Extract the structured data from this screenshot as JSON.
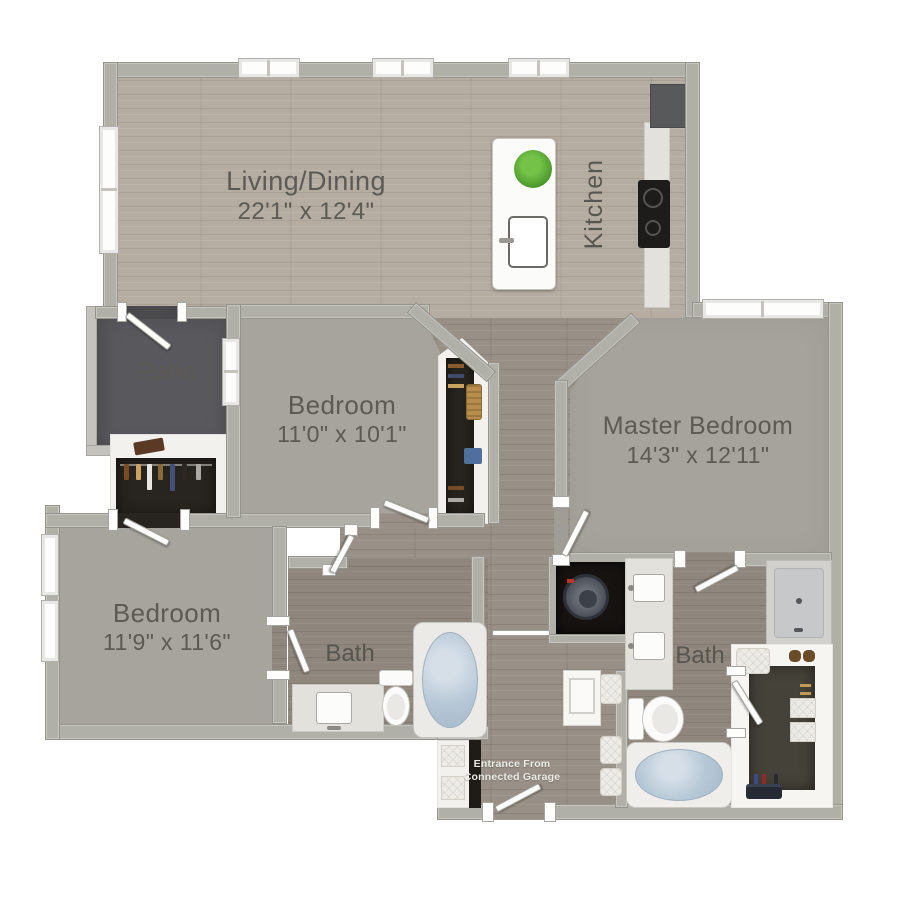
{
  "labels": {
    "living": {
      "name": "Living/Dining",
      "dims": "22'1\" x 12'4\""
    },
    "kitchen": {
      "name": "Kitchen"
    },
    "patio": {
      "name": "Patio"
    },
    "bedroom2": {
      "name": "Bedroom",
      "dims": "11'0\" x 10'1\""
    },
    "master": {
      "name": "Master Bedroom",
      "dims": "14'3\" x 12'11\""
    },
    "bedroom3": {
      "name": "Bedroom",
      "dims": "11'9\" x 11'6\""
    },
    "bath1": {
      "name": "Bath"
    },
    "bath2": {
      "name": "Bath"
    },
    "entrance": {
      "line1": "Entrance From",
      "line2": "Connected Garage"
    }
  },
  "fixtures": [
    "kitchen-island",
    "island-sink",
    "plant",
    "cooktop",
    "refrigerator",
    "washer",
    "bathtub",
    "toilet",
    "vanity-sink",
    "shower",
    "walk-in-closet",
    "closet",
    "bench-cushions",
    "storage-baskets"
  ],
  "colors": {
    "wall": "#b0afa8",
    "wood_living": "#b6ada2",
    "wood_hall": "#989087",
    "wood_bath": "#8f877d",
    "carpet": "#a7a39d",
    "patio": "#59585c",
    "closet_dark": "#28241f",
    "tub_water": "#b7c9d7",
    "label_text": "#5b5a54",
    "entry_text": "#ecebe5",
    "plant_green": "#55a237"
  }
}
